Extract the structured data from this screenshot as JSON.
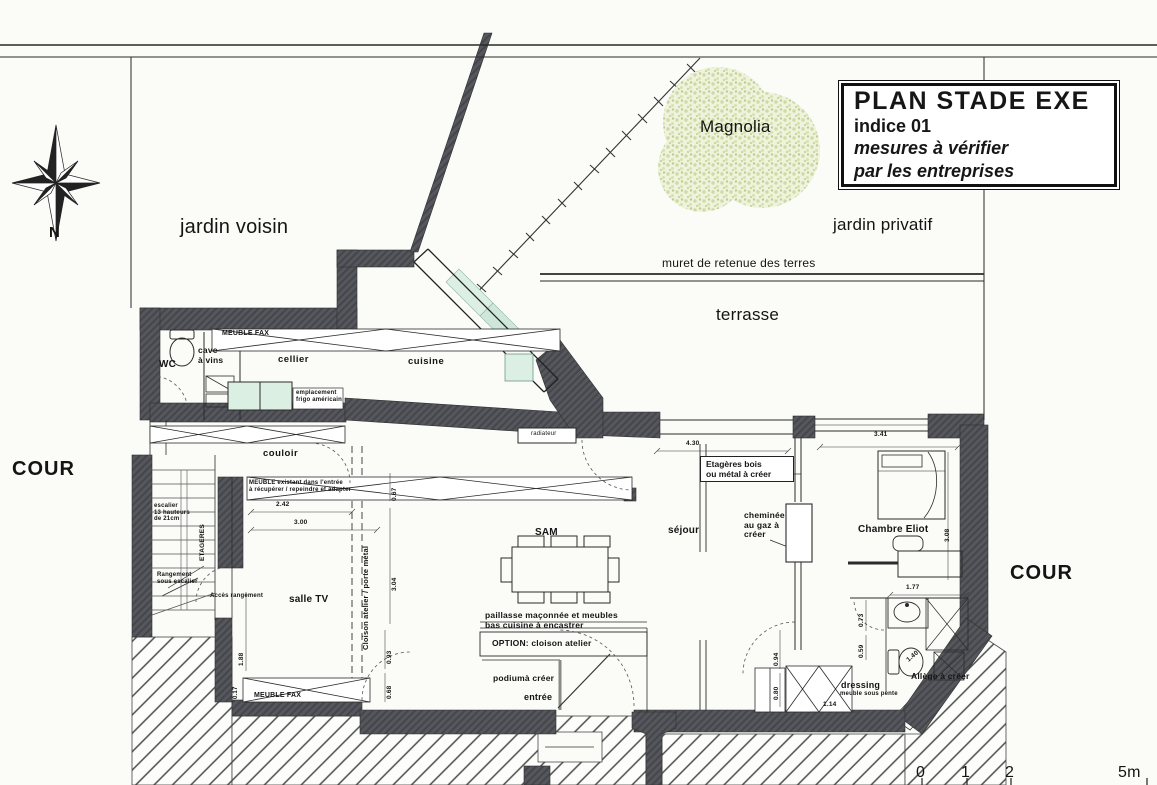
{
  "document": {
    "type_label": "PLAN STADE EXE",
    "indice": "indice 01",
    "note1": "mesures à vérifier",
    "note2": "par les entreprises"
  },
  "site": {
    "north": "N",
    "garden_neighbor": "jardin voisin",
    "garden_private": "jardin privatif",
    "tree": "Magnolia",
    "retaining_wall": "muret de retenue des terres",
    "terrace": "terrasse",
    "courtyard_west": "COUR",
    "courtyard_east": "COUR"
  },
  "rooms": {
    "wc": "WC",
    "cave": "cave\nà vins",
    "cellier": "cellier",
    "cuisine": "cuisine",
    "couloir": "couloir",
    "salle_tv": "salle TV",
    "sam": "SAM",
    "sejour": "séjour",
    "chambre": "Chambre Eliot",
    "entree": "entrée",
    "dressing": "dressing"
  },
  "annotations": {
    "meuble_fax_top": "MEUBLE FAX",
    "meuble_fax_bottom": "MEUBLE FAX",
    "frigo": "emplacement\nfrigo américain",
    "radiateur": "radiateur",
    "escalier": "escalier\n13 hauteurs\nde 21cm",
    "etageres": "ETAGERES",
    "meuble_existant": "MEUBLE existant dans l'entrée\nà récupérer / repeindre et adapter",
    "rangement": "Rangement\nsous escalier",
    "acces_rangement": "Accès rangement",
    "cloison_porte": "Cloison atelier / porte métal",
    "paillasse": "paillasse maçonnée et meubles\nbas cuisine à encastrer",
    "option_cloison": "OPTION: cloison atelier",
    "podium": "podiumà créer",
    "etageres_bois": "Etagères bois\nou métal à créer",
    "cheminee": "cheminée\nau gaz à\ncréer",
    "allege": "Allège à créer",
    "dressing_sub": "meuble sous pente"
  },
  "dimensions": {
    "d430": "4.30",
    "d341": "3.41",
    "d242": "2.42",
    "d300": "3.00",
    "d067": "0.67",
    "d304": "3.04",
    "d093": "0.93",
    "d068": "0.68",
    "d188": "1.88",
    "d177": "1.77",
    "d073": "0.73",
    "d059": "0.59",
    "d114": "1.14",
    "d140": "1.40",
    "d308": "3.08",
    "d094": "0.94",
    "d080": "0.80",
    "d017": "0.17"
  },
  "scale_bar": {
    "t0": "0",
    "t1": "1",
    "t2": "2",
    "t5": "5m"
  },
  "colors": {
    "wall": "#55565b",
    "glass": "#cfe7da",
    "glass_light": "#dcefe3",
    "tree_foliage": "#ccd89d",
    "paper": "#fbfbf8",
    "ink": "#1c1c1c"
  }
}
